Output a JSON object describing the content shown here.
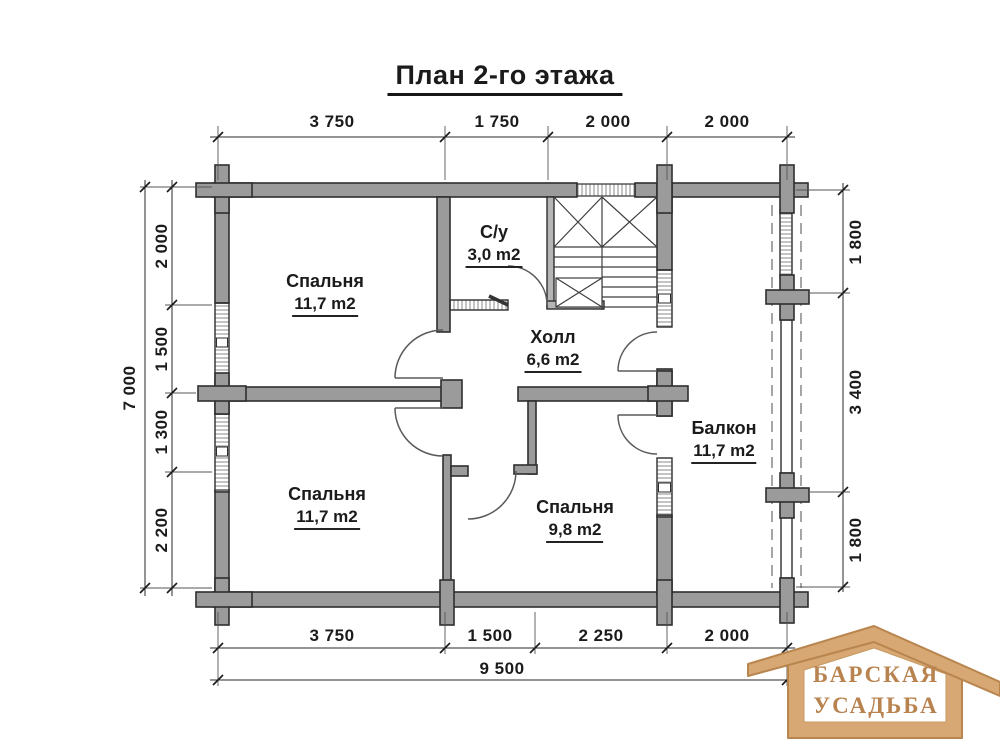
{
  "title": "План 2-го этажа",
  "dimensions": {
    "top": [
      "3 750",
      "1 750",
      "2 000",
      "2 000"
    ],
    "bottom": [
      "3 750",
      "1 500",
      "2 250",
      "2 000"
    ],
    "bottom_total": "9 500",
    "left": [
      "2 000",
      "1 500",
      "1 300",
      "2 200"
    ],
    "left_total": "7 000",
    "right": [
      "1 800",
      "3 400",
      "1 800"
    ]
  },
  "rooms": {
    "bedroom_top": {
      "name": "Спальня",
      "area": "11,7 m2"
    },
    "bathroom": {
      "name": "С/у",
      "area": "3,0 m2"
    },
    "hall": {
      "name": "Холл",
      "area": "6,6 m2"
    },
    "balcony": {
      "name": "Балкон",
      "area": "11,7 m2"
    },
    "bedroom_bottom_left": {
      "name": "Спальня",
      "area": "11,7 m2"
    },
    "bedroom_bottom_mid": {
      "name": "Спальня",
      "area": "9,8 m2"
    }
  },
  "logo": {
    "line1": "БАРСКАЯ",
    "line2": "УСАДЬБА"
  },
  "colors": {
    "wall_fill": "#9b9b9b",
    "wall_stroke": "#2e2e2e",
    "dim_line": "#2a2a2a",
    "door_arc": "#5a5a5a",
    "logo_wood": "#d7a873",
    "logo_wood_dark": "#b9854f",
    "logo_text": "#b9834f"
  }
}
